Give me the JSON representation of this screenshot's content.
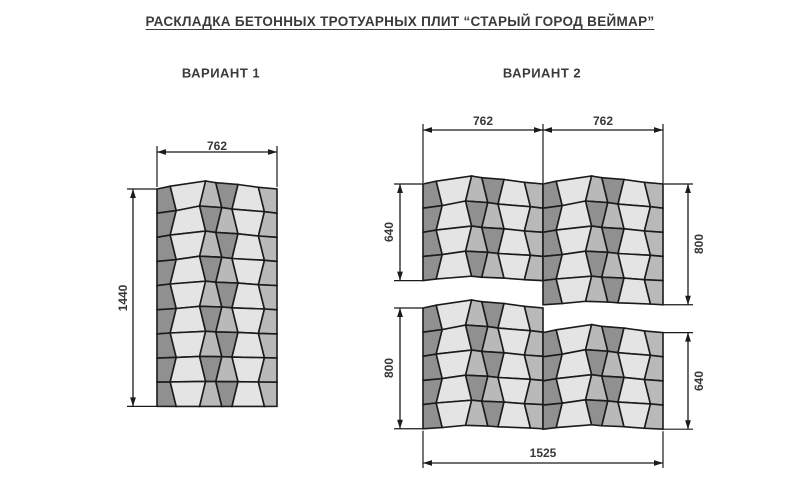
{
  "title": "РАСКЛАДКА БЕТОННЫХ ТРОТУАРНЫХ ПЛИТ “СТАРЫЙ ГОРОД ВЕЙМАР”",
  "variant1": {
    "label": "ВАРИАНТ 1",
    "width_mm": "762",
    "height_mm": "1440",
    "rows": 9
  },
  "variant2": {
    "label": "ВАРИАНТ 2",
    "width_left_mm": "762",
    "width_right_mm": "762",
    "total_width_mm": "1525",
    "bands": [
      {
        "left_rows": 4,
        "right_rows": 5,
        "left_dim_mm": "640",
        "right_dim_mm": "800",
        "right_offset_rows": 0
      },
      {
        "left_rows": 5,
        "right_rows": 4,
        "left_dim_mm": "800",
        "right_dim_mm": "640",
        "right_offset_rows": 1
      }
    ]
  },
  "colors": {
    "tile_dark": "#909090",
    "tile_medium": "#b9b9b9",
    "tile_light": "#e4e4e4",
    "line": "#1b1b1b",
    "text": "#3a3a3a",
    "background": "#ffffff"
  }
}
